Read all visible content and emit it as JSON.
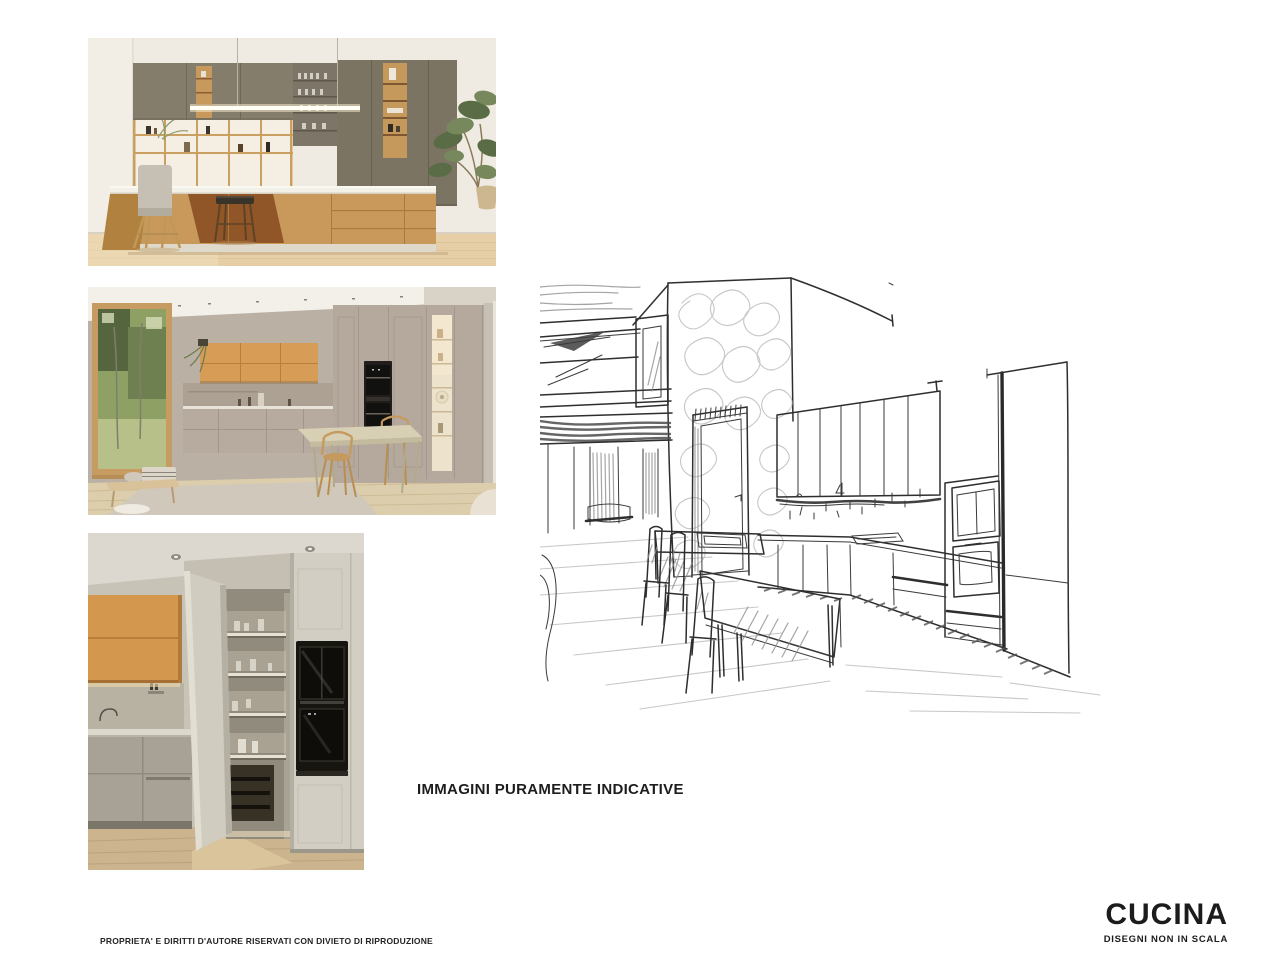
{
  "page": {
    "background_color": "#ffffff",
    "caption": "IMMAGINI PURAMENTE INDICATIVE",
    "footer_note": "PROPRIETA' E DIRITTI D'AUTORE RISERVATI CON DIVIETO DI RIPRODUZIONE",
    "title_block": {
      "title": "CUCINA",
      "subtitle": "DISEGNI NON IN SCALA"
    }
  },
  "photos": [
    {
      "label": "kitchen-island-photo",
      "description": "Kitchen with olive-green wall units, oak island with bar stools and linear pendant light"
    },
    {
      "label": "kitchen-dining-photo",
      "description": "Kitchen with taupe cabinetry, oak wall units, garden window, black ovens and small dining table"
    },
    {
      "label": "kitchen-pantry-photo",
      "description": "Kitchen corner with oak upper cabinet, open pantry door with illuminated shelves and built-in black ovens"
    }
  ],
  "sketch": {
    "label": "kitchen-perspective-sketch",
    "description": "Hand-drawn perspective sketch of the kitchen: mezzanine at left, doorway, wall cabinets, oven column, island with hob, dining table and chairs"
  },
  "colors": {
    "ink": "#2e2e2e",
    "pencil": "#b5b5b5",
    "photo_olive": "#7b7463",
    "photo_oak": "#c9995b",
    "photo_taupe": "#b5a99d",
    "photo_floor": "#dcc8a4"
  }
}
